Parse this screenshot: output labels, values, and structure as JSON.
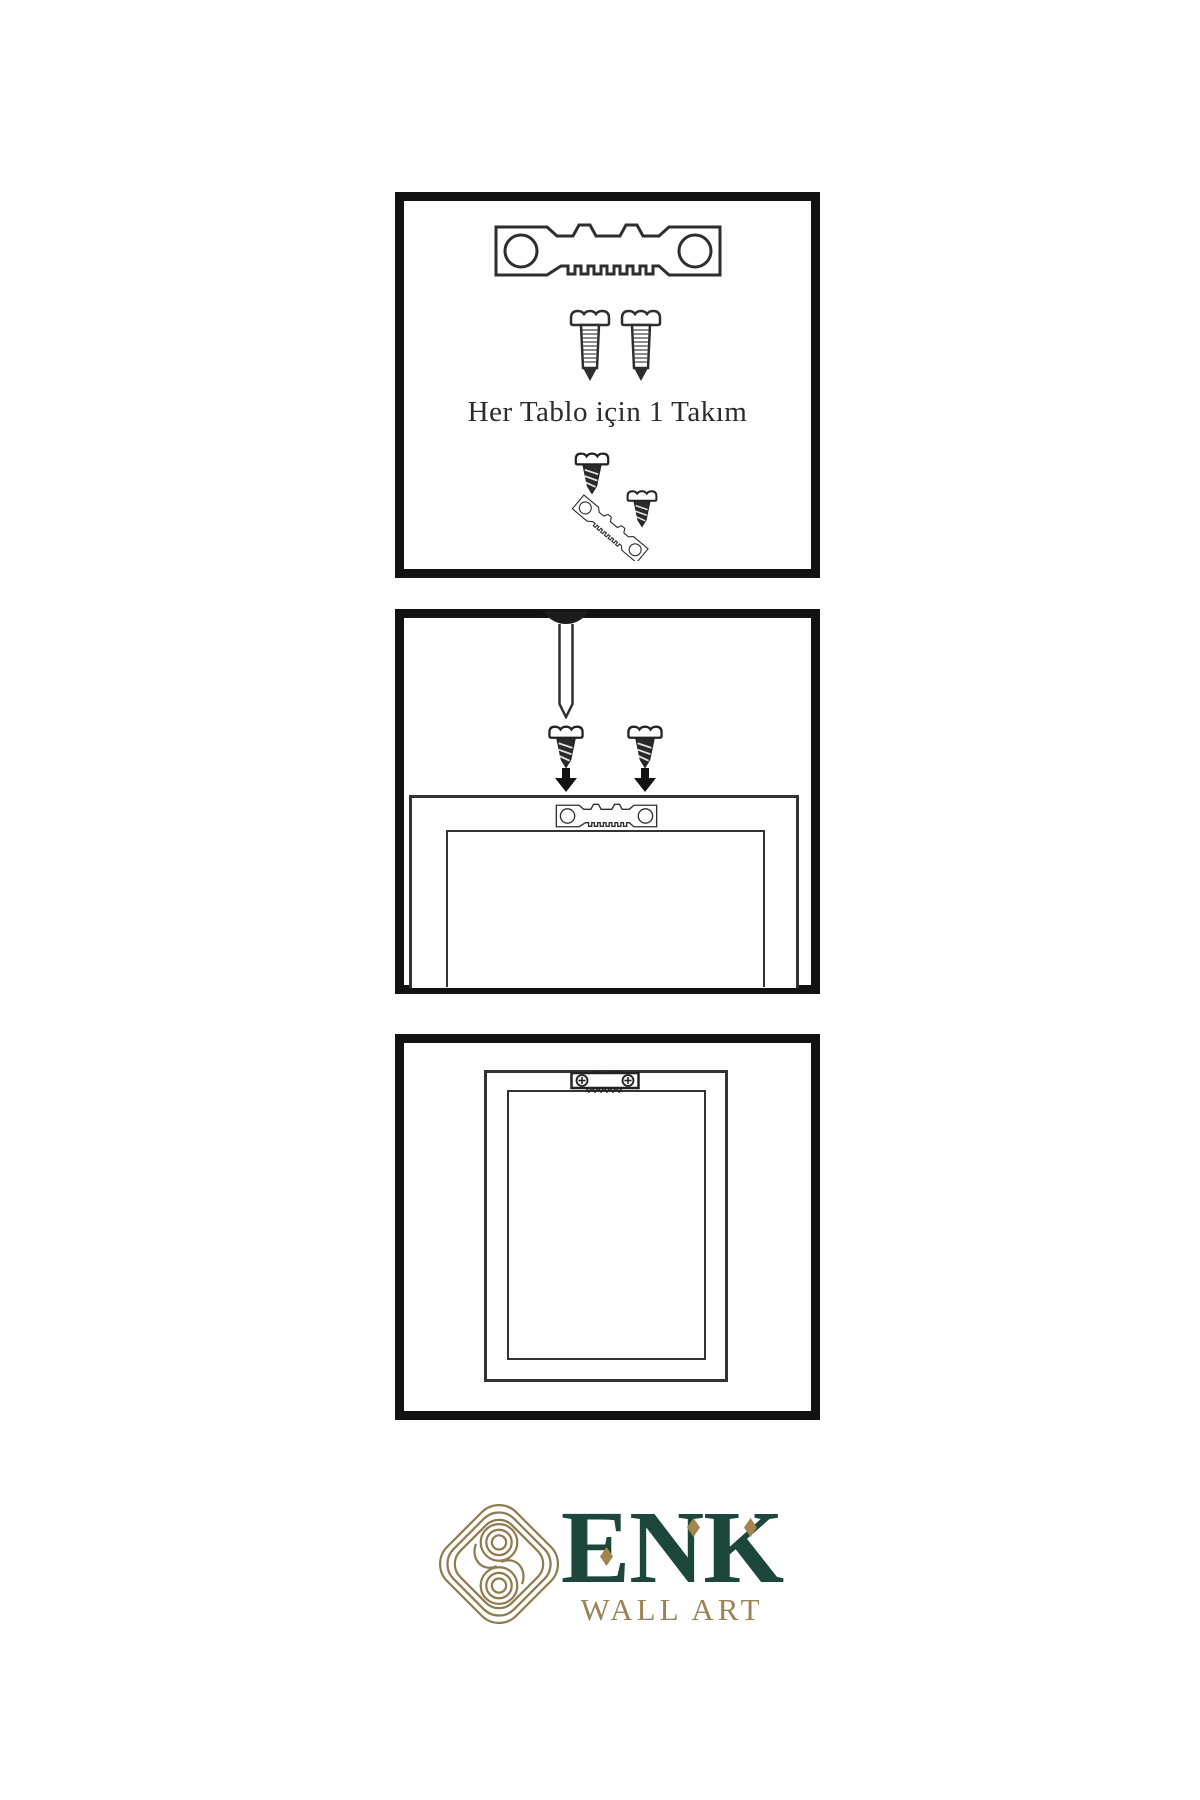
{
  "page": {
    "type": "product-instruction-sheet",
    "background": "#ffffff"
  },
  "colors": {
    "panel_border": "#121212",
    "line_art": "#2e2e2e",
    "screw_dark_fill": "#2a2a2a",
    "caption_text": "#2b2b2b",
    "logo_green": "#1d463c",
    "logo_gold": "#9a8354",
    "knot_gold": "#8e7b50"
  },
  "steps": [
    {
      "name": "hardware-set",
      "caption": "Her Tablo için 1 Takım",
      "icons": [
        "sawtooth-hanger-icon",
        "mounting-screw-icon",
        "mounting-screw-icon",
        "screw-and-hanger-assembly-icon"
      ]
    },
    {
      "name": "attach-hanger-to-frame",
      "icons": [
        "wall-nail-icon",
        "screw-with-down-arrow-icon",
        "screw-with-down-arrow-icon",
        "frame-back-outline",
        "sawtooth-hanger-icon"
      ]
    },
    {
      "name": "hang-frame-on-wall",
      "icons": [
        "frame-back-outline",
        "installed-sawtooth-hanger-icon"
      ]
    }
  ],
  "logo": {
    "brand": "ENK",
    "subtitle": "WALL ART",
    "brand_icon": "interlocking-knot-icon",
    "diamond_accents": 3
  }
}
